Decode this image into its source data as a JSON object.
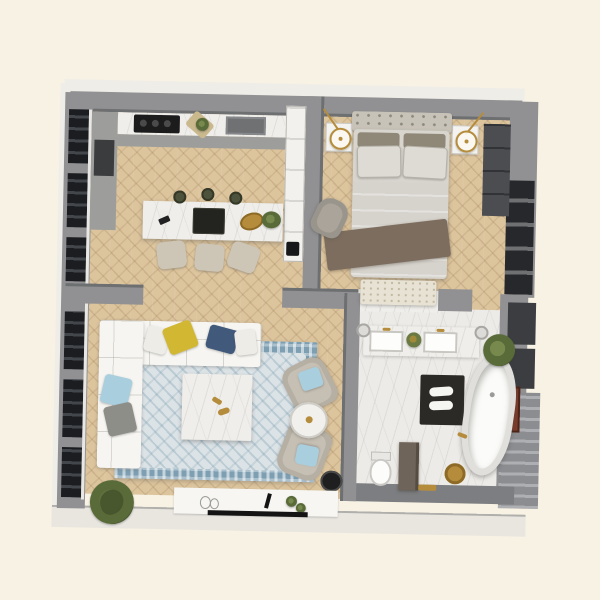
{
  "scene": {
    "title": "3D rendered apartment floor plan, top-down view",
    "background": "#f8f2e4",
    "rotation_deg": 1.2,
    "visible_text": []
  },
  "palette": {
    "bg": "#f8f2e4",
    "wood": "#dcc49d",
    "marble": "#efeeea",
    "bathFloor": "#edebe7",
    "wallGray": "#919193",
    "wallDark": "#6d6f71",
    "windowDark": "#26282b",
    "sofa": "#f6f5f1",
    "rugBorder": "#7e9fb2",
    "rugField": "#dce3e6",
    "headboard": "#c8c3b8",
    "bedLinen": "#d8d5ce",
    "throwBrown": "#7c6d5e",
    "bench": "#e7e2d4",
    "chair": "#b6afa3",
    "stool": "#cdc6b6",
    "gold": "#b58c3c",
    "pillowYellow": "#d2b832",
    "pillowNavy": "#41597a",
    "pillowBlue": "#a9cede",
    "matDark": "#2c2a26",
    "tub": "#fbfbf9",
    "nicheRust": "#7c3c2b",
    "outerBand": "#efede7"
  },
  "rooms": [
    {
      "name": "kitchen-dining",
      "floor": "herringbone wood",
      "furniture": [
        "wall counter with black cooktop",
        "dark undermount sink",
        "tall white cabinet column",
        "kitchen island with marble top",
        "three bar stools",
        "three dark pendant lights",
        "serving tray",
        "gold fruit bowl",
        "potted herb"
      ]
    },
    {
      "name": "bedroom",
      "floor": "herringbone wood",
      "furniture": [
        "double bed with tufted headboard",
        "two back pillows",
        "two sleeping pillows",
        "brown throw blanket",
        "foot bench",
        "two white nightstands",
        "two gold pendant lamps",
        "gray armchair",
        "dark wardrobe",
        "window wall"
      ]
    },
    {
      "name": "living-room",
      "floor": "herringbone wood",
      "furniture": [
        "L-shaped white sectional sofa",
        "yellow pillow",
        "navy pillow",
        "light-blue pillow",
        "gray pillow",
        "blue persian rug",
        "marble coffee table",
        "white media console",
        "flat TV panel",
        "two taupe lounge chairs",
        "round side table",
        "black side table",
        "large potted plant"
      ]
    },
    {
      "name": "bathroom",
      "floor": "white marble",
      "furniture": [
        "double vanity with gold faucets",
        "two round wall sconces",
        "freestanding oval bathtub",
        "gold floor faucet",
        "dark bath mat with white towels",
        "toilet",
        "privacy partition",
        "gold stool",
        "potted plant",
        "rust artwork niche"
      ]
    }
  ]
}
